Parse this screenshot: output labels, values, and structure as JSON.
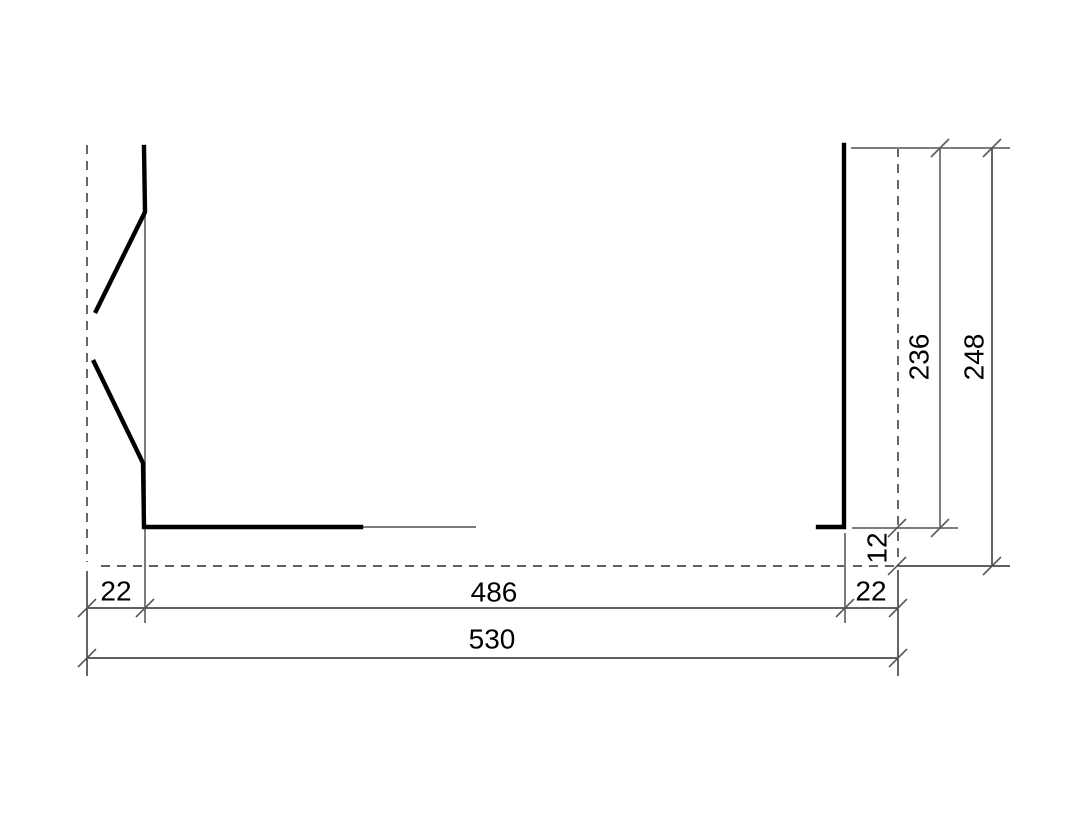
{
  "drawing": {
    "kind": "cad-profile-cross-section-dimension-drawing",
    "canvas": {
      "width": 1087,
      "height": 815,
      "background": "#ffffff"
    },
    "colors": {
      "profile_stroke": "#000000",
      "extension_gray": "#7d7d7d",
      "dimension_black": "#000000",
      "reference_dashed": "#000000",
      "tick": "#5a5a5a",
      "text": "#000000"
    },
    "labels": {
      "left_flange_width": "22",
      "opening_width": "486",
      "right_flange_width": "22",
      "overall_width": "530",
      "bottom_inset": "12",
      "inner_height": "236",
      "overall_height": "248"
    }
  }
}
